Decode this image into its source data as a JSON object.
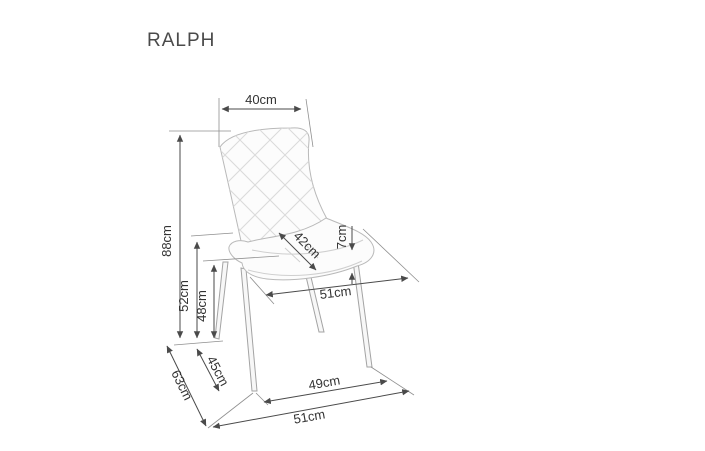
{
  "header": {
    "title": "RALPH"
  },
  "diagram": {
    "product": "upholstered-chair-technical-drawing",
    "units": "cm",
    "line_color": "#4a4a4a",
    "sketch_color": "#b9b9b9",
    "dimensions": {
      "backrest_width": "40cm",
      "total_height": "88cm",
      "seat_back_height": "52cm",
      "seat_height": "48cm",
      "seat_width": "42cm",
      "cushion_thickness": "7cm",
      "seat_depth": "51cm",
      "base_depth": "63cm",
      "leg_span_side": "45cm",
      "front_leg_span": "49cm",
      "base_width": "51cm"
    }
  }
}
